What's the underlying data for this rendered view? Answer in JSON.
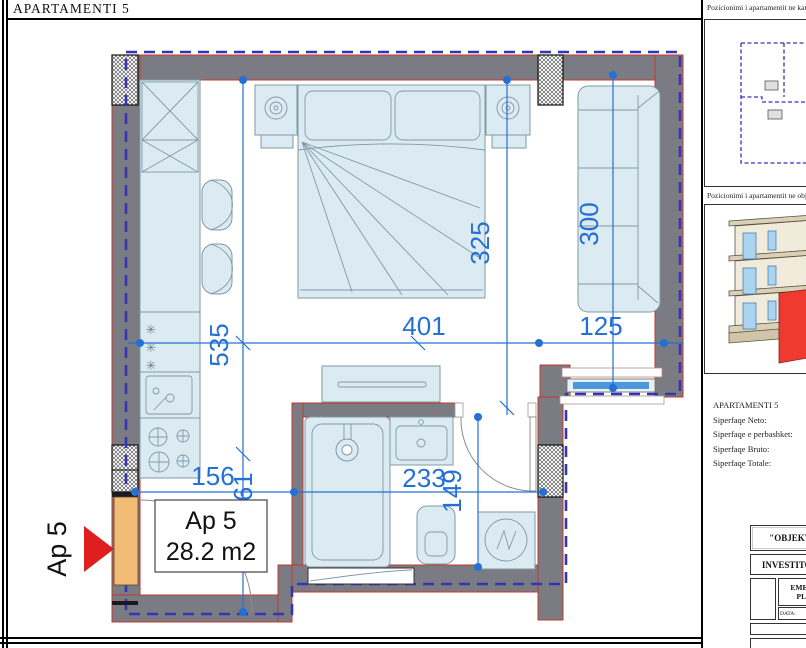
{
  "frame": {
    "title": "APARTAMENTI 5"
  },
  "plan": {
    "dims": {
      "d535": "535",
      "d401": "401",
      "d125": "125",
      "d325": "325",
      "d300": "300",
      "d156": "156",
      "d161": "161",
      "d233": "233",
      "d149": "149"
    },
    "apartment_box": {
      "line1": "Ap 5",
      "line2": "28.2 m2"
    },
    "entry_label": "Ap 5",
    "freezer_stars": [
      "✳",
      "✳",
      "✳"
    ]
  },
  "sidebar": {
    "kat_label": "Pozicionimi i apartamentit ne kat",
    "objekt_label": "Pozicionimi i apartamentit ne objekt",
    "info": {
      "title": "APARTAMENTI 5",
      "neto": "Siperfaqe Neto:",
      "perbashket": "Siperfaqe e perbashket:",
      "bruto": "Siperfaqe Bruto:",
      "totale": "Siperfaqe Totale:"
    },
    "titleblock": {
      "objekt": "\"OBJEKT",
      "investitor": "INVESTITOR",
      "emertimi": "EMERT",
      "plani": "PLA",
      "data": "DATA:"
    }
  },
  "colors": {
    "wall": "#7b7b83",
    "wall_outline": "#c0392b",
    "boundary": "#3434b4",
    "dim": "#2470d4",
    "furniture_fill": "#dcebf1",
    "furniture_stroke": "#7f99a8",
    "door": "#f2bc76",
    "glass": "#4f97dd",
    "arrow": "#df1f1f",
    "building_red": "#ee3a31"
  }
}
